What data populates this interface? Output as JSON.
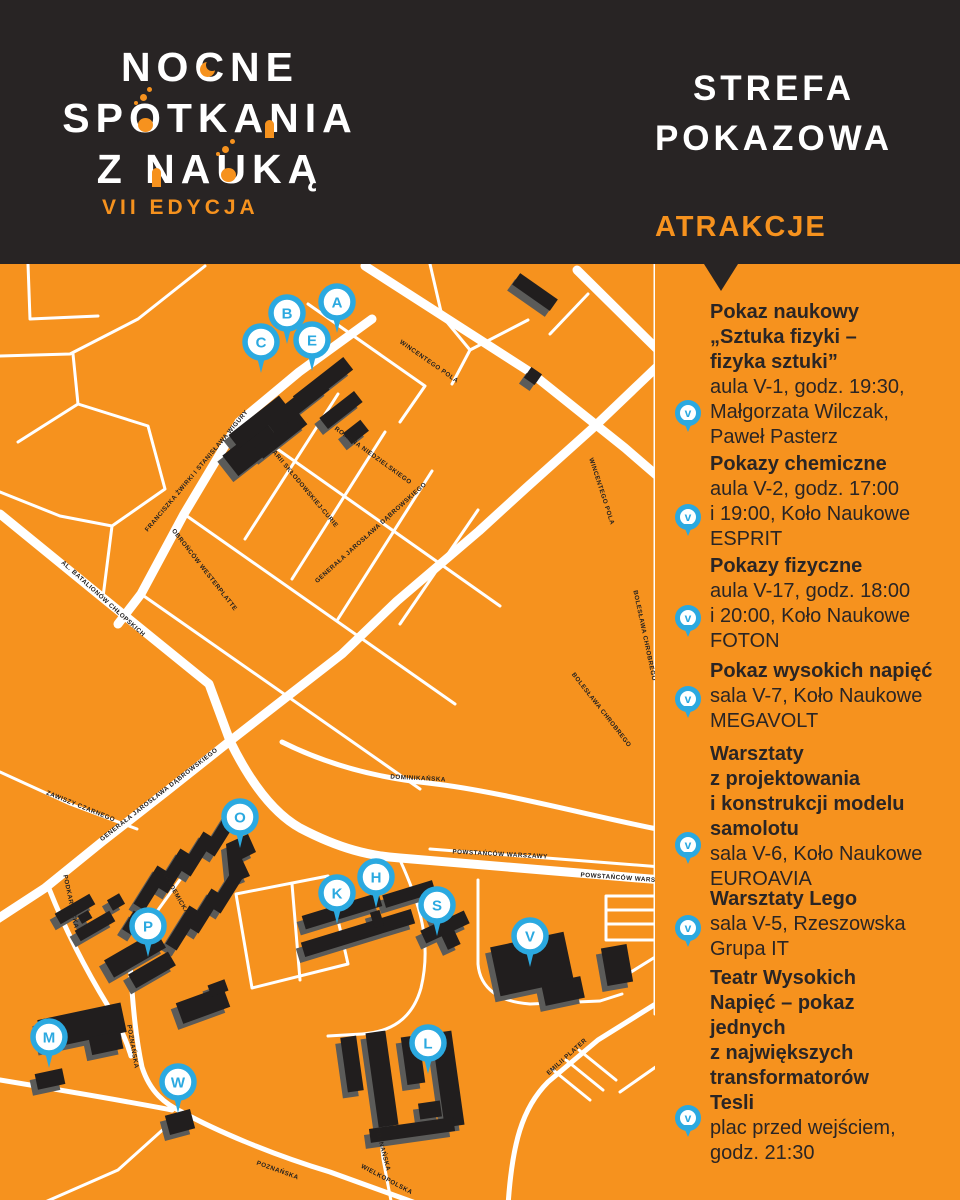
{
  "header": {
    "logo_line1": "NOCNE",
    "logo_line2": "SPOTKANIA",
    "logo_line3": "Z NAUKĄ",
    "edition": "VII EDYCJA",
    "zone_title": "STREFA\nPOKAZOWA",
    "attractions_label": "ATRAKCJE"
  },
  "colors": {
    "orange": "#F6921E",
    "dark": "#282424",
    "blue": "#2BA9E0",
    "white": "#FFFFFF",
    "building": "#211E1E",
    "building_shadow": "#5B5B59",
    "text_dark": "#2A2525"
  },
  "map": {
    "markers": [
      {
        "letter": "A",
        "x": 337,
        "y": 38
      },
      {
        "letter": "B",
        "x": 287,
        "y": 49
      },
      {
        "letter": "C",
        "x": 261,
        "y": 78
      },
      {
        "letter": "E",
        "x": 312,
        "y": 76
      },
      {
        "letter": "O",
        "x": 240,
        "y": 553
      },
      {
        "letter": "P",
        "x": 148,
        "y": 662
      },
      {
        "letter": "K",
        "x": 337,
        "y": 629
      },
      {
        "letter": "H",
        "x": 376,
        "y": 613
      },
      {
        "letter": "S",
        "x": 437,
        "y": 641
      },
      {
        "letter": "V",
        "x": 530,
        "y": 672
      },
      {
        "letter": "M",
        "x": 49,
        "y": 773
      },
      {
        "letter": "W",
        "x": 178,
        "y": 818
      },
      {
        "letter": "L",
        "x": 428,
        "y": 779
      }
    ],
    "street_labels": [
      {
        "text": "WINCENTEGO POLA",
        "x": 428,
        "y": 99,
        "angle": 35
      },
      {
        "text": "WINCENTEGO POLA",
        "x": 600,
        "y": 228,
        "angle": 72
      },
      {
        "text": "ROMANA NIEDZIELSKIEGO",
        "x": 372,
        "y": 193,
        "angle": 36
      },
      {
        "text": "BOLESŁAWA CHROBREGO",
        "x": 643,
        "y": 372,
        "angle": 78
      },
      {
        "text": "BOLESŁAWA CHROBREGO",
        "x": 600,
        "y": 447,
        "angle": 52
      },
      {
        "text": "FRANCISZKA ŻWIRKI I STANISŁAWA WIGURY",
        "x": 198,
        "y": 208,
        "angle": -50
      },
      {
        "text": "MARII SKŁODOWSKIEJ-CURIE",
        "x": 302,
        "y": 224,
        "angle": 50
      },
      {
        "text": "GENERAŁA JAROSŁAWA DĄBROWSKIEGO",
        "x": 372,
        "y": 270,
        "angle": -42
      },
      {
        "text": "GENERAŁA JAROSŁAWA DĄBROWSKIEGO",
        "x": 160,
        "y": 532,
        "angle": -38
      },
      {
        "text": "AL. BATALIONÓW CHŁOPSKICH",
        "x": 102,
        "y": 336,
        "angle": 42
      },
      {
        "text": "OBROŃCÓW WESTERPLATTE",
        "x": 203,
        "y": 307,
        "angle": 52
      },
      {
        "text": "ZAWISZY CZARNEGO",
        "x": 80,
        "y": 544,
        "angle": 22
      },
      {
        "text": "PODKARPACKA",
        "x": 69,
        "y": 638,
        "angle": 78
      },
      {
        "text": "AKADEMICKA",
        "x": 174,
        "y": 630,
        "angle": 60
      },
      {
        "text": "POZNAŃSKA",
        "x": 131,
        "y": 783,
        "angle": 80
      },
      {
        "text": "POZNAŃSKA",
        "x": 277,
        "y": 908,
        "angle": 20
      },
      {
        "text": "POZNAŃSKA",
        "x": 381,
        "y": 886,
        "angle": 75
      },
      {
        "text": "WIELKOPOLSKA",
        "x": 386,
        "y": 917,
        "angle": 28
      },
      {
        "text": "POWSTAŃCÓW WARSZAWY",
        "x": 500,
        "y": 592,
        "angle": 3
      },
      {
        "text": "POWSTAŃCÓW WARSZAWY",
        "x": 628,
        "y": 616,
        "angle": 4
      },
      {
        "text": "DOMINIKAŃSKA",
        "x": 418,
        "y": 516,
        "angle": 3
      },
      {
        "text": "EMILII PLATER",
        "x": 568,
        "y": 794,
        "angle": -42
      }
    ]
  },
  "sidebar": {
    "pin_letter": "V",
    "items": [
      {
        "title": [
          "Pokaz naukowy",
          "„Sztuka fizyki –",
          "fizyka sztuki”"
        ],
        "details": [
          "aula V-1, godz. 19:30,",
          "Małgorzata Wilczak,",
          "Paweł Pasterz"
        ]
      },
      {
        "title": [
          "Pokazy chemiczne"
        ],
        "details": [
          "aula V-2, godz. 17:00",
          "i 19:00, Koło Naukowe",
          "ESPRIT"
        ]
      },
      {
        "title": [
          "Pokazy fizyczne"
        ],
        "details": [
          "aula V-17, godz. 18:00",
          "i 20:00, Koło Naukowe",
          "FOTON"
        ]
      },
      {
        "title": [
          "Pokaz wysokich napięć"
        ],
        "details": [
          "sala V-7, Koło Naukowe",
          "MEGAVOLT"
        ]
      },
      {
        "title": [
          "Warsztaty",
          "z projektowania",
          "i konstrukcji modelu",
          "samolotu"
        ],
        "details": [
          "sala V-6, Koło Naukowe",
          "EUROAVIA"
        ]
      },
      {
        "title": [
          "Warsztaty Lego"
        ],
        "details": [
          "sala V-5, Rzeszowska",
          "Grupa IT"
        ]
      },
      {
        "title": [
          "Teatr Wysokich",
          "Napięć – pokaz",
          "jednych",
          "z największych",
          "transformatorów",
          "Tesli"
        ],
        "details": [
          "plac przed wejściem,",
          "godz. 21:30"
        ]
      }
    ]
  }
}
